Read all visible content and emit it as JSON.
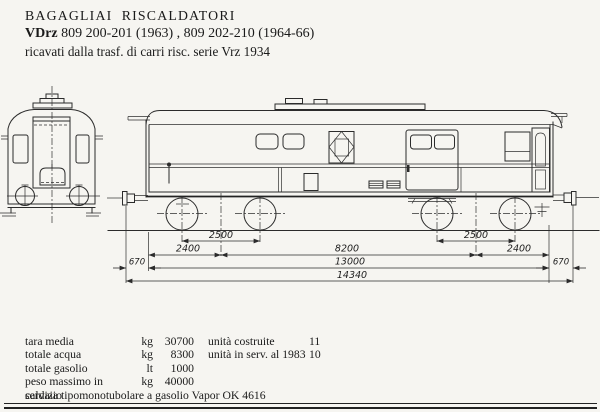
{
  "header": {
    "title": "BAGAGLIAI  RISCALDATORI",
    "subtitle_bold": "VDrz",
    "subtitle_rest": " 809 200-201 (1963) , 809 202-210 (1964-66)",
    "line3": "ricavati dalla trasf. di carri risc. serie Vrz 1934"
  },
  "drawing": {
    "description": "side and end elevation of heated baggage van",
    "dimensions": {
      "bogie_wheelbase_left": "2500",
      "bogie_wheelbase_right": "2500",
      "pivot_to_end_left": "2400",
      "pivot_spacing": "8200",
      "pivot_to_end_right": "2400",
      "buffer_left": "670",
      "body_length": "13000",
      "buffer_right": "670",
      "total_length": "14340"
    }
  },
  "specs": {
    "left": [
      {
        "label": "tara media",
        "unit": "kg",
        "value": "30700"
      },
      {
        "label": "totale acqua",
        "unit": "kg",
        "value": "8300"
      },
      {
        "label": "totale gasolio",
        "unit": "lt",
        "value": "1000"
      },
      {
        "label": "peso massimo in servizio",
        "unit": "kg",
        "value": "40000"
      }
    ],
    "right": [
      {
        "label": "unità costruite",
        "value": "11"
      },
      {
        "label": "unità in serv. al 1983",
        "value": "10"
      }
    ],
    "footnote": "caldaia tipomonotubolare a gasolio Vapor OK 4616"
  }
}
